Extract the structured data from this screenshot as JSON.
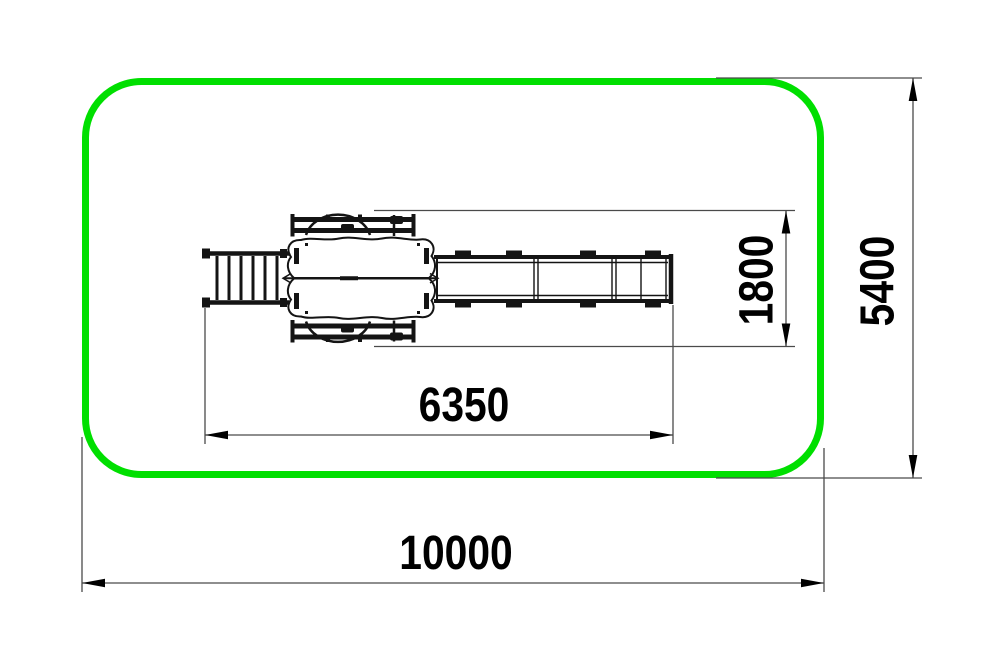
{
  "colors": {
    "safety_zone_outline": "#00df00",
    "equipment_lines": "#141414",
    "dimension_lines": "#4a4a4a",
    "dimension_text": "#000000",
    "background": "#ffffff"
  },
  "drawing": {
    "view": "top-view plan of playground slide unit with safety zone",
    "components": [
      "safety-zone-outline",
      "access-ladder",
      "platform-tower",
      "slide"
    ]
  },
  "dimensions": {
    "total_length": {
      "label": "10000",
      "orientation": "horizontal"
    },
    "total_width": {
      "label": "5400",
      "orientation": "vertical"
    },
    "equipment_length": {
      "label": "6350",
      "orientation": "horizontal"
    },
    "equipment_width": {
      "label": "1800",
      "orientation": "vertical"
    }
  }
}
